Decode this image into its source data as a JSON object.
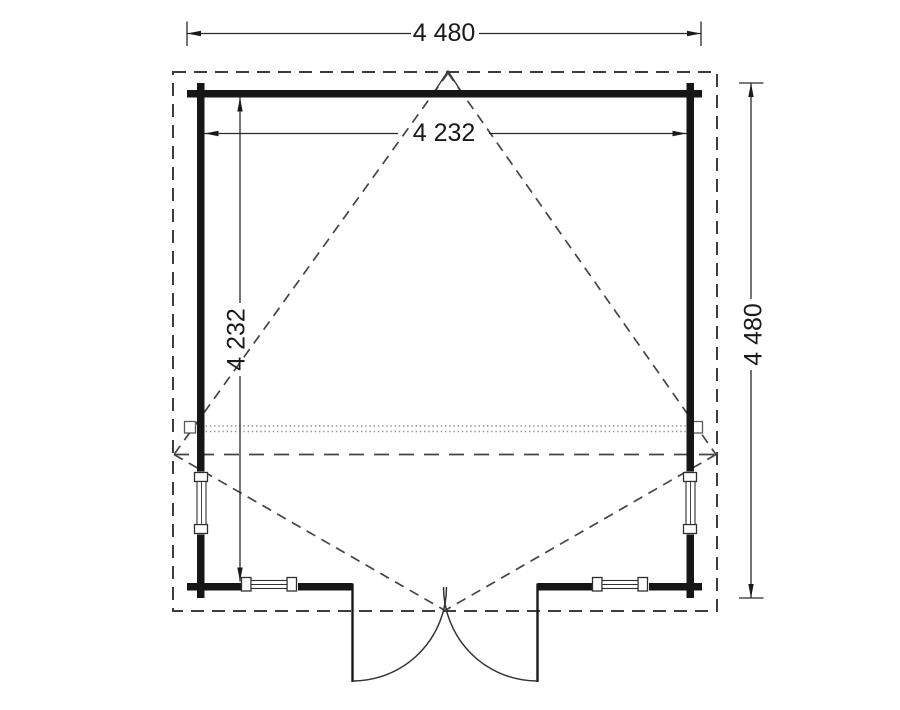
{
  "plan": {
    "type": "log-cabin floor plan",
    "dimensions": {
      "overall_width_mm": "4 480",
      "overall_depth_mm": "4 480",
      "internal_width_mm": "4 232",
      "internal_depth_mm": "4 232"
    },
    "symbols": {
      "door": "double-door-outward-swing",
      "windows": [
        "left-wall-window",
        "right-wall-window",
        "front-left-window",
        "front-right-window"
      ],
      "roof": "dashed-overhang-outline-with-ridge-lines",
      "beam": "dotted-overhead-ridge-beam"
    }
  },
  "colors": {
    "ink": "#1a1a1a",
    "wall": "#161616",
    "dash": "#454545",
    "dotted": "#8f8f8f",
    "dim": "#2a2a2a",
    "bg": "#ffffff"
  }
}
